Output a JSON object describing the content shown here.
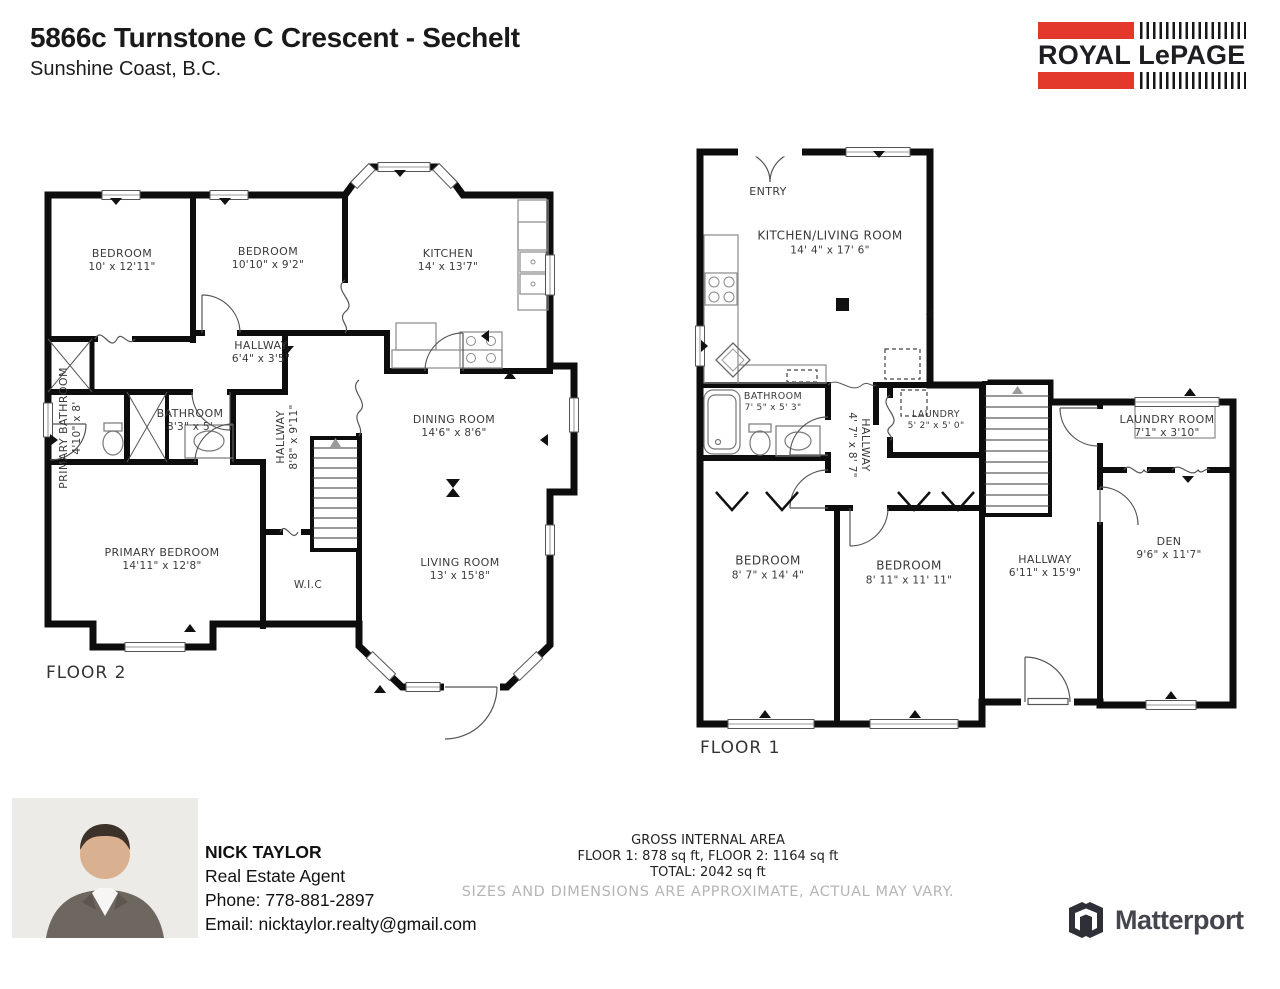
{
  "header": {
    "title": "5866c Turnstone C Crescent - Sechelt",
    "subtitle": "Sunshine Coast, B.C."
  },
  "royal_lepage": {
    "name": "ROYAL LePAGE"
  },
  "matterport": {
    "name": "Matterport"
  },
  "floor2": {
    "label": "FLOOR 2",
    "rooms": {
      "bedroom1": {
        "name": "BEDROOM",
        "dims": "10' x 12'11\""
      },
      "bedroom2": {
        "name": "BEDROOM",
        "dims": "10'10\" x 9'2\""
      },
      "kitchen": {
        "name": "KITCHEN",
        "dims": "14' x 13'7\""
      },
      "hallway": {
        "name": "HALLWAY",
        "dims": "6'4\" x 3'5\""
      },
      "primary_bathroom": {
        "name": "PRIMARY BATHROOM",
        "dims": "4'10\" x 8'"
      },
      "bathroom": {
        "name": "BATHROOM",
        "dims": "8'3\" x 5'"
      },
      "hallway2": {
        "name": "HALLWAY",
        "dims": "8'8\" x 9'11\""
      },
      "primary_bedroom": {
        "name": "PRIMARY BEDROOM",
        "dims": "14'11\" x 12'8\""
      },
      "dining_room": {
        "name": "DINING ROOM",
        "dims": "14'6\" x 8'6\""
      },
      "living_room": {
        "name": "LIVING ROOM",
        "dims": "13' x 15'8\""
      },
      "wic": {
        "name": "W.I.C"
      }
    }
  },
  "floor1": {
    "label": "FLOOR 1",
    "rooms": {
      "entry": {
        "name": "ENTRY"
      },
      "kitchen_living": {
        "name": "KITCHEN/LIVING ROOM",
        "dims": "14' 4\" x 17' 6\""
      },
      "bathroom": {
        "name": "BATHROOM",
        "dims": "7' 5\" x 5' 3\""
      },
      "hallway": {
        "name": "HALLWAY",
        "dims": "4' 7\" x 8' 7\""
      },
      "laundry": {
        "name": "LAUNDRY",
        "dims": "5' 2\" x 5' 0\""
      },
      "bedroom1": {
        "name": "BEDROOM",
        "dims": "8' 7\" x 14' 4\""
      },
      "bedroom2": {
        "name": "BEDROOM",
        "dims": "8' 11\" x 11' 11\""
      },
      "laundry_room": {
        "name": "LAUNDRY ROOM",
        "dims": "7'1\" x 3'10\""
      },
      "den": {
        "name": "DEN",
        "dims": "9'6\" x 11'7\""
      },
      "hallway2": {
        "name": "HALLWAY",
        "dims": "6'11\" x 15'9\""
      }
    }
  },
  "agent": {
    "name": "NICK TAYLOR",
    "role": "Real Estate Agent",
    "phone": "Phone: 778-881-2897",
    "email": "Email: nicktaylor.realty@gmail.com"
  },
  "area": {
    "title": "GROSS INTERNAL AREA",
    "floors": "FLOOR 1: 878 sq ft, FLOOR 2: 1164 sq ft",
    "total": "TOTAL: 2042 sq ft",
    "disclaimer": "SIZES AND DIMENSIONS ARE APPROXIMATE, ACTUAL MAY VARY."
  },
  "colors": {
    "brand_red": "#e2392c",
    "wall_black": "#0d0d0d",
    "label_gray": "#3a3a3a",
    "disclaimer_gray": "#b5b5b5",
    "matterport_gray": "#45454d"
  }
}
